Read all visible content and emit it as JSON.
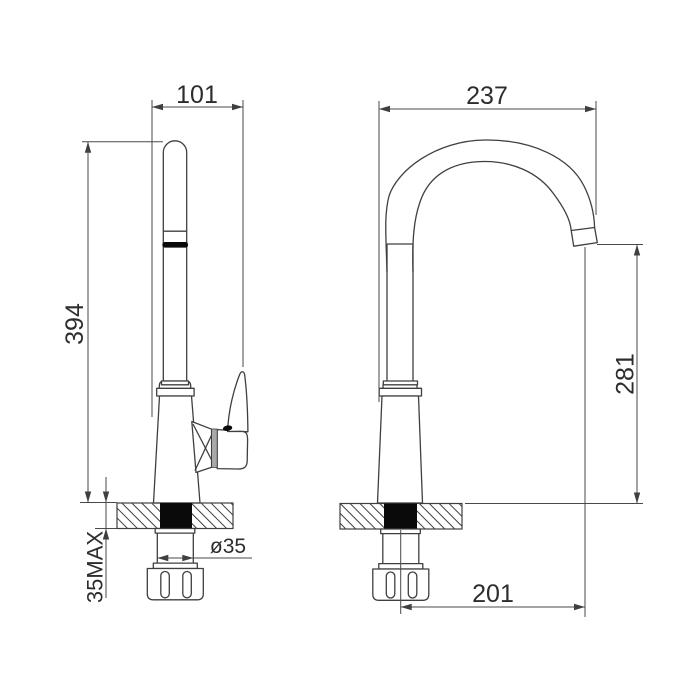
{
  "drawing": {
    "subject": "kitchen-faucet-two-view-dimension-drawing",
    "units": "mm",
    "dimensions": {
      "front_depth": "101",
      "arc_width": "237",
      "total_height": "394",
      "outlet_height": "281",
      "spout_reach": "201",
      "hole_diameter": "ø35",
      "max_deck_thickness": "35MAX"
    },
    "colors": {
      "line": "#3f3f3f",
      "dimension_line": "#4a4a4a",
      "text": "#2d2d2d",
      "solid_fill": "#0a0a0a",
      "cartridge_gray": "#a8a8a8",
      "background": "#ffffff"
    }
  }
}
